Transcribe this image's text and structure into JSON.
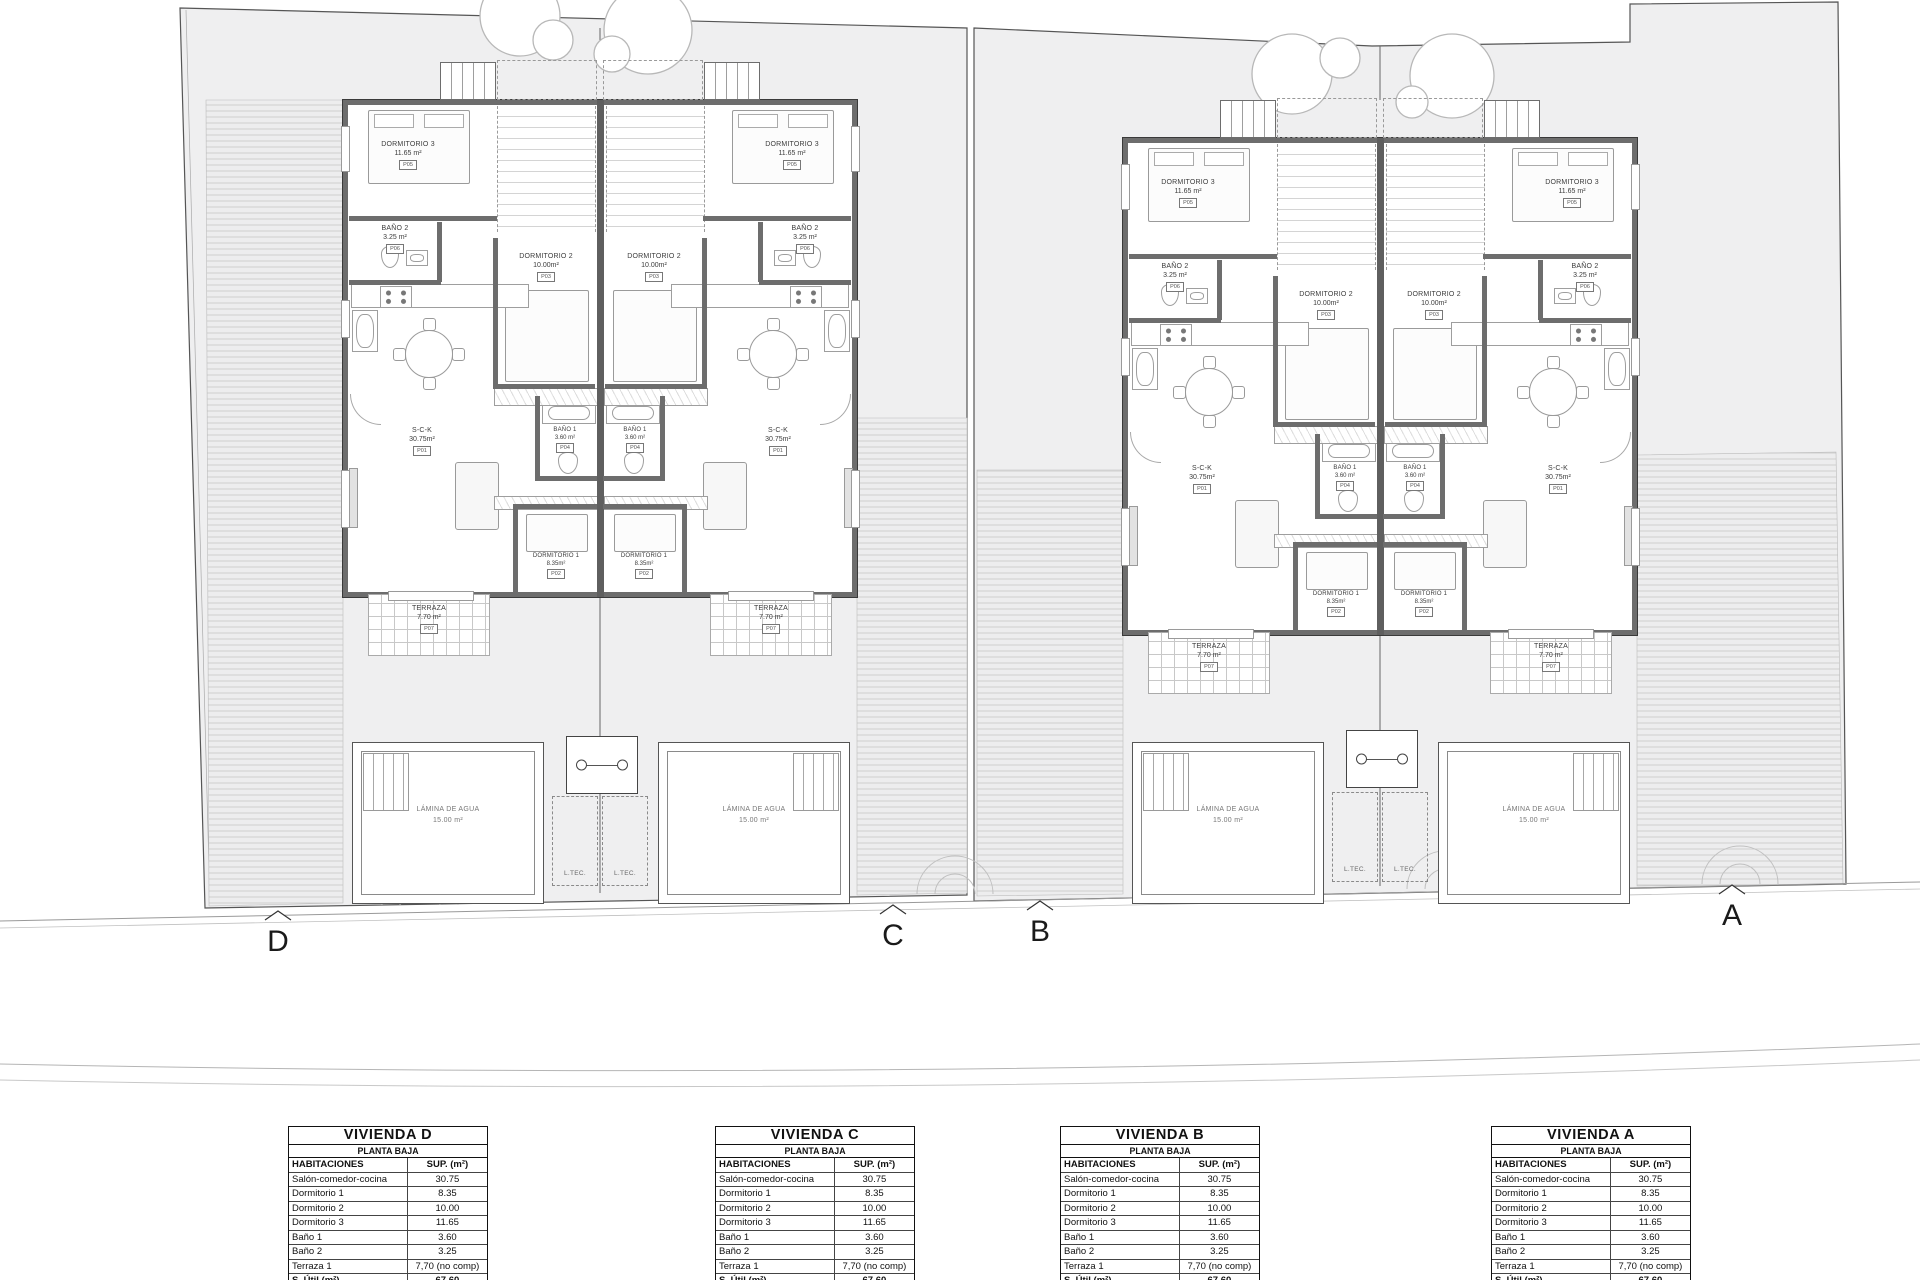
{
  "drawing": {
    "section_markers": [
      "D",
      "C",
      "B",
      "A"
    ],
    "rooms": {
      "dormitorio3": {
        "name": "DORMITORIO 3",
        "area": "11.65 m²",
        "tag": "P05"
      },
      "bano2": {
        "name": "BAÑO 2",
        "area": "3.25 m²",
        "tag": "P06"
      },
      "dormitorio2": {
        "name": "DORMITORIO 2",
        "area": "10.00m²",
        "tag": "P03"
      },
      "sck": {
        "name": "S-C-K",
        "area": "30.75m²",
        "tag": "P01"
      },
      "bano1": {
        "name": "BAÑO 1",
        "area": "3.60 m²",
        "tag": "P04"
      },
      "dormitorio1": {
        "name": "DORMITORIO 1",
        "area": "8.35m²",
        "tag": "P02"
      },
      "terraza": {
        "name": "TERRAZA",
        "area": "7.70 m²",
        "tag": "P07"
      }
    },
    "pool": {
      "label": "LÁMINA DE AGUA",
      "area": "15.00 m²"
    },
    "ltec_label": "L.TEC."
  },
  "tables": {
    "titles": [
      "VIVIENDA D",
      "VIVIENDA C",
      "VIVIENDA B",
      "VIVIENDA A"
    ],
    "subtitle": "PLANTA BAJA",
    "headers": [
      "HABITACIONES",
      "SUP. (m²)"
    ],
    "rows": [
      [
        "Salón-comedor-cocina",
        "30.75"
      ],
      [
        "Dormitorio 1",
        "8.35"
      ],
      [
        "Dormitorio 2",
        "10.00"
      ],
      [
        "Dormitorio 3",
        "11.65"
      ],
      [
        "Baño 1",
        "3.60"
      ],
      [
        "Baño 2",
        "3.25"
      ],
      [
        "Terraza 1",
        "7,70 (no comp)"
      ]
    ],
    "total": [
      "S. Útil (m²)",
      "67.60"
    ]
  }
}
